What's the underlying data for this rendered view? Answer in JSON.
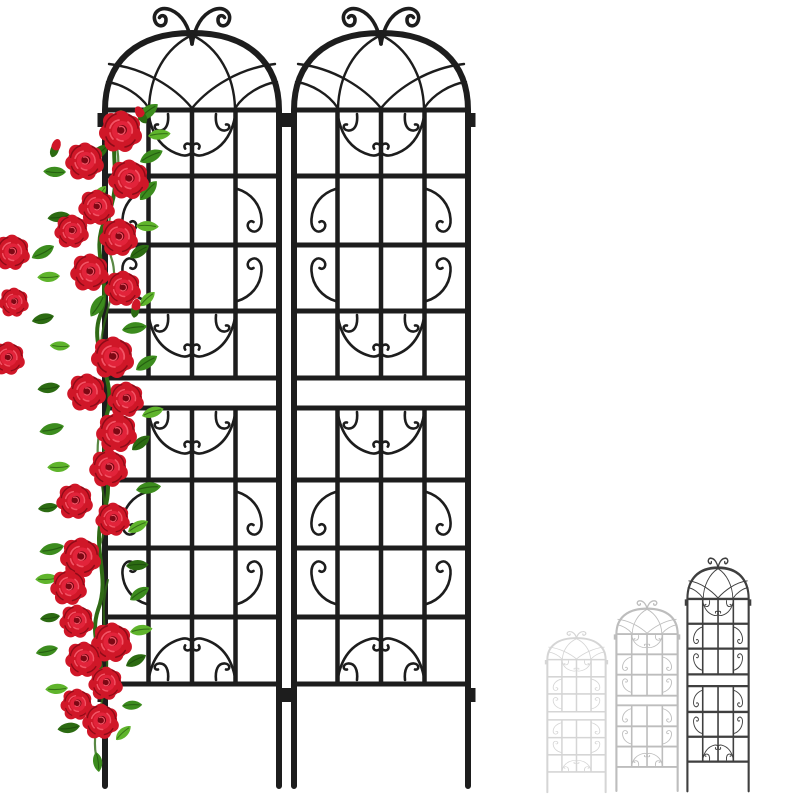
{
  "scene": {
    "alt": "Product photo: two tall black ornamental metal garden trellis panels with arched scrollwork tops standing side by side, a red climbing rose vine growing up the left panel, and three grey trellis size variants shown at the lower right",
    "background": "#ffffff"
  },
  "product": {
    "panels_shown": 2,
    "size_variants_shown": 3,
    "rose_blossoms_visible": 26,
    "ornament_motifs": [
      "double-scroll finial",
      "gothic arch tracery",
      "butterfly scroll",
      "mirrored C-scrolls",
      "ground stakes"
    ]
  },
  "colors": {
    "background": "#ffffff",
    "trellis": "#1d1d1d",
    "ghost_small": "#d5d5d5",
    "ghost_medium": "#bdbdbd",
    "ghost_large": "#3f3f3f",
    "rose_base": "#b50e1f",
    "rose_mid": "#d01728",
    "rose_bright": "#e2233a",
    "rose_core": "#7d0814",
    "rose_highlight": "#f25566",
    "rose_shadow": "#8e0c18",
    "leaf_green": "#3c8c1e",
    "leaf_dark": "#2c6b12",
    "leaf_light": "#5fb42c",
    "leaf_pale": "#79c93e",
    "stem": "#2f6a15"
  }
}
